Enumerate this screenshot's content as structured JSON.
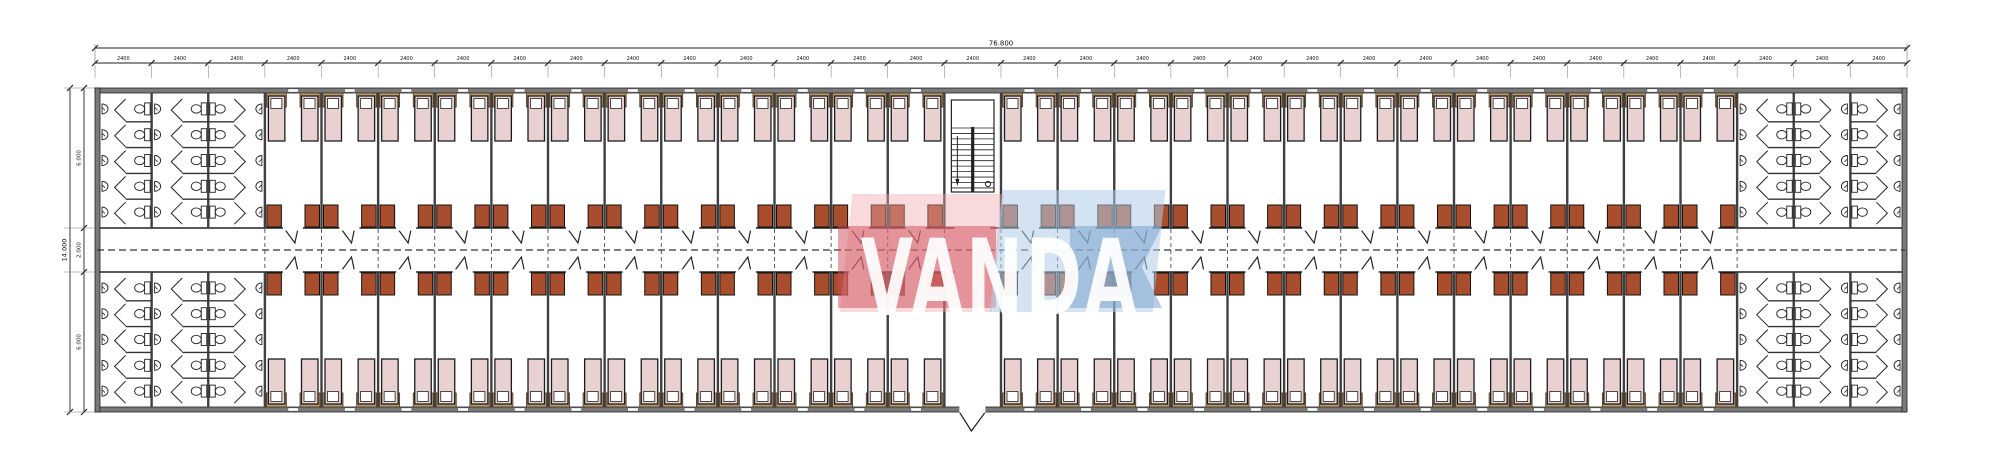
{
  "logo": {
    "text": "VANDA",
    "colors": {
      "red": "#cf4a57",
      "pink": "#eda8af",
      "blue": "#7ea2ce",
      "light_blue": "#b0cce6",
      "letters": "#ffffff"
    }
  },
  "dimensions": {
    "top_total_label": "76.800",
    "top_bay_label": "2400",
    "top_bay_count": 32,
    "left_total_label": "14.000",
    "left_segment_labels": [
      "6.000",
      "2.000",
      "6.000"
    ]
  },
  "plan": {
    "bay_count": 32,
    "bathroom_bays_per_end": 3,
    "stair_bay_number": 16,
    "rooms_top_row": 25,
    "rooms_bottom_row": 25,
    "beds_per_room": 2,
    "wardrobes_per_room": 2,
    "toilet_stalls_per_column": 5,
    "washbasins_per_column": 5,
    "symbols": {
      "bed": "bed",
      "pillow": "pillow",
      "bed_headboard": "bed-headboard",
      "wardrobe": "wardrobe-unit",
      "toilet": "toilet-icon",
      "washbasin": "washbasin-icon",
      "stair": "staircase",
      "room_door": "door-swing",
      "entrance_door": "entrance-door",
      "corridor_centerline": "corridor-centerline",
      "window": "window-opening"
    },
    "colors": {
      "bed": "#e9d0d1",
      "pillow": "#ffffff",
      "bed_header": "#b59a70",
      "wardrobe": "#a84e2c",
      "wall_fill": "#7a7a7a",
      "line": "#222222",
      "dash": "#333333"
    }
  }
}
